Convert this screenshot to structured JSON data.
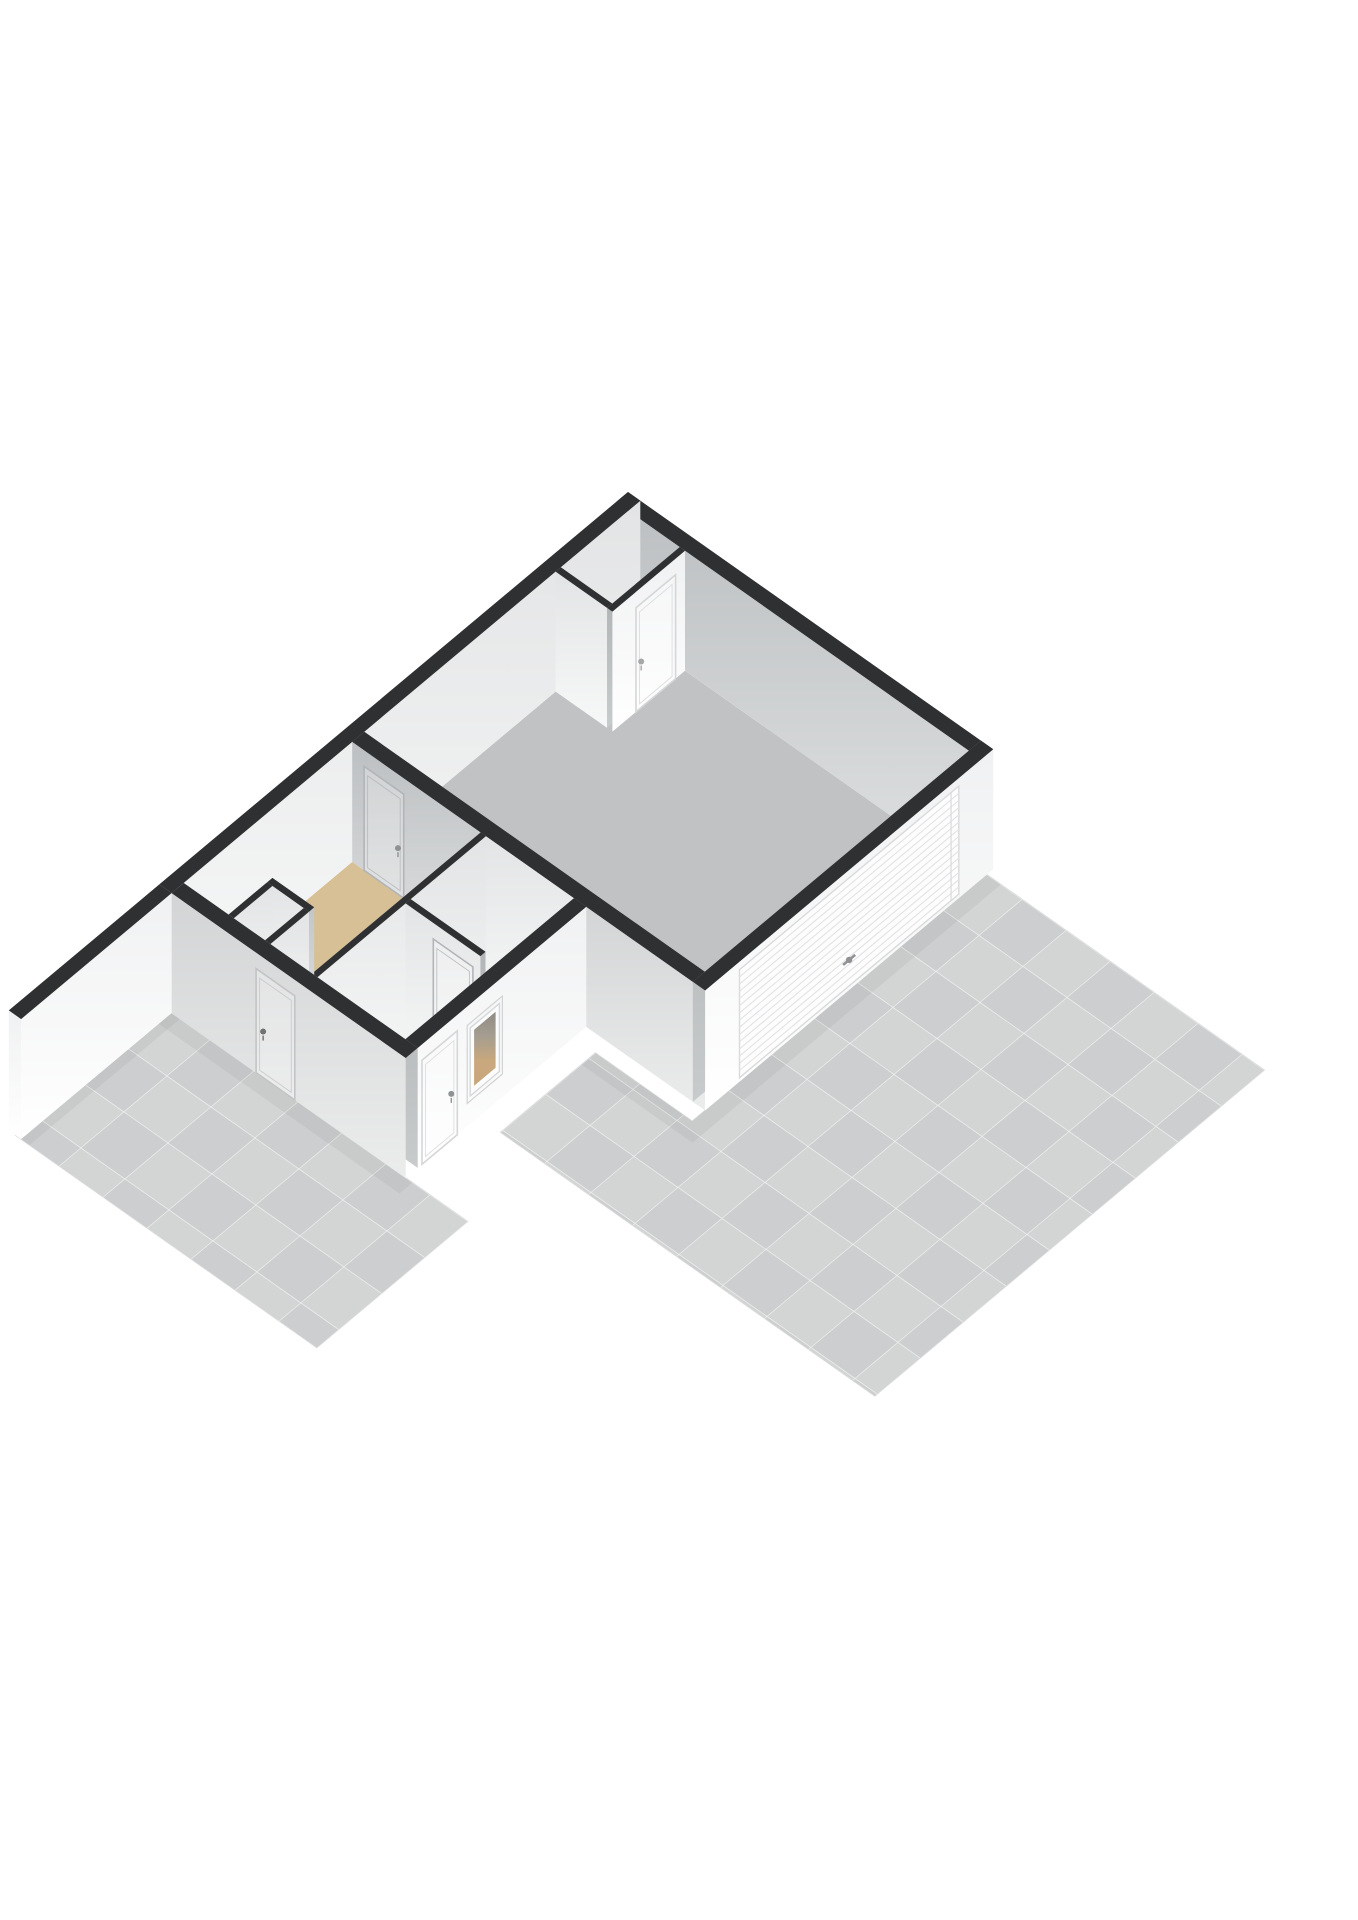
{
  "meta": {
    "type": "3d-floorplan-render",
    "background": "#ffffff",
    "canvas": [
      1358,
      1920
    ]
  },
  "projection": {
    "origin": [
      628,
      612
    ],
    "u": [
      44,
      31
    ],
    "v": [
      -43,
      36
    ],
    "wallHeight": 120
  },
  "palette": {
    "cap": "#2e3032",
    "floorGray": "#c0c2c3",
    "floorTan": "#d7bf96",
    "floorWhite": "#f1f2f2",
    "floorClosetGray": "#c7c9ca",
    "floorCloset2": "#ededee",
    "patioBase": "#d0d1d2",
    "tileEven": "#d3d4d4",
    "tileOdd": "#cdcecf",
    "tileLine": "rgba(255,255,255,0.45)",
    "patioEdge": "#dcdddd",
    "shade": "rgba(0,0,0,0.045)",
    "doorFrameWhite": "#d5d6d7",
    "doorFrameGray": "#b2b5b7",
    "doorFrameExt": "#c3c4c5",
    "handleDark": "#6f7173",
    "handleMid": "#8f9193",
    "handleLight": "#a5a7a9",
    "slatLine": "#e2e3e4",
    "slatBorder": "#d9dadb",
    "gradients": {
      "faceDark": [
        "#a9acae",
        "#c8cbcc"
      ],
      "faceMid": [
        "#bcbfc1",
        "#dfe1e2"
      ],
      "faceLight": [
        "#e3e4e5",
        "#f7f8f8"
      ],
      "faceWhite": [
        "#f0f1f2",
        "#ffffff"
      ],
      "faceExtGray": [
        "#d3d4d5",
        "#ebecec"
      ],
      "windowOpening": [
        "#8f8b85",
        "#a59d90",
        "#c9a87d",
        "#c8a77c"
      ]
    }
  },
  "patios": [
    {
      "name": "right-patio",
      "poly": [
        [
          8.3,
          0.15
        ],
        [
          14.6,
          0.15
        ],
        [
          14.6,
          9.2
        ],
        [
          6.1,
          9.2
        ],
        [
          6.1,
          7.0
        ],
        [
          8.3,
          7.0
        ]
      ],
      "tileOrigin": [
        6.1,
        0.15
      ],
      "tileCount": [
        9,
        10
      ],
      "shades": [
        [
          [
            8.3,
            0.15
          ],
          [
            8.62,
            0.15
          ],
          [
            8.62,
            7.0
          ],
          [
            8.3,
            7.0
          ]
        ],
        [
          [
            6.1,
            7.0
          ],
          [
            8.62,
            7.0
          ],
          [
            8.62,
            7.32
          ],
          [
            6.1,
            7.32
          ]
        ]
      ]
    },
    {
      "name": "left-patio",
      "poly": [
        [
          0.15,
          10.9
        ],
        [
          7.0,
          10.9
        ],
        [
          7.0,
          14.4
        ],
        [
          0.15,
          14.4
        ]
      ],
      "tileOrigin": [
        0.15,
        10.9
      ],
      "tileCount": [
        7,
        4
      ],
      "shades": [
        [
          [
            0.15,
            10.9
          ],
          [
            5.75,
            10.9
          ],
          [
            5.75,
            11.2
          ],
          [
            0.15,
            11.2
          ]
        ],
        [
          [
            0.15,
            10.9
          ],
          [
            0.47,
            10.9
          ],
          [
            0.47,
            14.4
          ],
          [
            0.15,
            14.4
          ]
        ]
      ]
    }
  ],
  "floors": [
    {
      "name": "garage-floor",
      "fill": "floorGray",
      "poly": [
        [
          0.28,
          0.28
        ],
        [
          8.02,
          0.28
        ],
        [
          8.02,
          6.42
        ],
        [
          0.28,
          6.42
        ]
      ]
    },
    {
      "name": "closet-floor",
      "fill": "floorClosetGray",
      "poly": [
        [
          0.28,
          0.28
        ],
        [
          1.45,
          0.28
        ],
        [
          1.45,
          1.85
        ],
        [
          0.28,
          1.85
        ]
      ]
    },
    {
      "name": "tan-room-floor",
      "fill": "floorTan",
      "poly": [
        [
          0.28,
          6.7
        ],
        [
          3.2,
          6.7
        ],
        [
          3.2,
          10.62
        ],
        [
          2.25,
          10.62
        ],
        [
          2.25,
          9.6
        ],
        [
          1.3,
          9.6
        ],
        [
          1.3,
          10.62
        ],
        [
          0.28,
          10.62
        ]
      ]
    },
    {
      "name": "toilet-floor",
      "fill": "floorWhite",
      "poly": [
        [
          3.32,
          6.7
        ],
        [
          5.02,
          6.7
        ],
        [
          5.02,
          8.45
        ],
        [
          3.32,
          8.45
        ]
      ]
    },
    {
      "name": "hall-floor",
      "fill": "floorWhite",
      "poly": [
        [
          3.32,
          8.57
        ],
        [
          5.02,
          8.57
        ],
        [
          5.02,
          10.62
        ],
        [
          3.32,
          10.62
        ]
      ]
    },
    {
      "name": "closet2-floor",
      "fill": "floorCloset2",
      "poly": [
        [
          1.42,
          9.72
        ],
        [
          2.13,
          9.72
        ],
        [
          2.13,
          10.62
        ],
        [
          1.42,
          10.62
        ]
      ]
    }
  ],
  "walls": [
    {
      "name": "wall-northeast",
      "rect": [
        0,
        8.3,
        0,
        0.28
      ],
      "faces": [
        {
          "side": "+y",
          "fill": "faceMid"
        }
      ]
    },
    {
      "name": "wall-northwest",
      "rect": [
        0,
        0.28,
        0,
        10.9
      ],
      "faces": [
        {
          "side": "+x",
          "fill": "faceLight"
        }
      ]
    },
    {
      "name": "closet-wall-south",
      "rect": [
        0.28,
        1.45,
        1.85,
        1.97
      ],
      "faces": [
        {
          "side": "-y",
          "fill": "faceDark"
        },
        {
          "side": "+y",
          "fill": "faceLight"
        }
      ]
    },
    {
      "name": "closet-wall-east",
      "rect": [
        1.45,
        1.57,
        0.28,
        1.97
      ],
      "faces": [
        {
          "side": "-x",
          "fill": "faceDark"
        },
        {
          "side": "+x",
          "fill": "faceWhite",
          "features": [
            {
              "type": "door",
              "t0": 0.5,
              "t1": 1.42,
              "z1": 104,
              "frame": "doorFrameWhite",
              "handle": {
                "t": 1.3,
                "z": 46,
                "color": "handleLight"
              }
            }
          ]
        }
      ]
    },
    {
      "name": "wall-garage-south",
      "rect": [
        0.28,
        8.3,
        6.42,
        6.7
      ],
      "faces": [
        {
          "side": "-y",
          "fill": "faceDark"
        },
        {
          "side": "+y",
          "t0": 0.28,
          "t1": 3.26,
          "fill": "faceMid",
          "features": [
            {
              "type": "door",
              "t0": 0.55,
              "t1": 1.45,
              "z1": 104,
              "frame": "doorFrameGray",
              "handle": {
                "t": 1.32,
                "z": 46,
                "color": "handleMid"
              }
            }
          ]
        },
        {
          "side": "+y",
          "t0": 3.26,
          "t1": 5.45,
          "fill": "faceLight"
        },
        {
          "side": "+y",
          "t0": 5.45,
          "t1": 8.3,
          "fill": "faceExtGray"
        }
      ]
    },
    {
      "name": "wall-partition-tan",
      "rect": [
        3.2,
        3.32,
        6.7,
        10.62
      ],
      "faces": [
        {
          "side": "-x",
          "fill": "faceMid",
          "features": [
            {
              "type": "door",
              "t0": 6.85,
              "t1": 7.75,
              "z1": 104,
              "frame": "doorFrameGray",
              "handle": {
                "t": 7.6,
                "z": 46,
                "color": "handleMid"
              }
            }
          ]
        },
        {
          "side": "+x",
          "fill": "faceLight"
        }
      ]
    },
    {
      "name": "wall-partition-hall",
      "rect": [
        3.32,
        5.02,
        8.45,
        8.57
      ],
      "faces": [
        {
          "side": "-y",
          "fill": "faceDark"
        },
        {
          "side": "+y",
          "fill": "faceLight",
          "features": [
            {
              "type": "door",
              "t0": 3.95,
              "t1": 4.85,
              "z1": 104,
              "frame": "doorFrameGray",
              "handle": {
                "t": 4.7,
                "z": 46,
                "color": "handleMid"
              }
            }
          ]
        }
      ]
    },
    {
      "name": "wall-garage-east",
      "rect": [
        8.02,
        8.3,
        0,
        6.7
      ],
      "faces": [
        {
          "side": "-x",
          "fill": "faceDark"
        },
        {
          "side": "+x",
          "fill": "faceWhite",
          "features": [
            {
              "type": "slats",
              "t0": 0.8,
              "t1": 5.9,
              "z0": 4,
              "z1": 112,
              "count": 15
            },
            {
              "type": "handle",
              "t": 3.35,
              "z": 30,
              "color": "handleMid"
            }
          ]
        }
      ]
    },
    {
      "name": "closet2-wall-north",
      "rect": [
        1.3,
        2.25,
        9.6,
        9.72
      ],
      "faces": [
        {
          "side": "-y",
          "fill": "faceMid"
        },
        {
          "side": "+y",
          "fill": "faceLight"
        }
      ]
    },
    {
      "name": "closet2-wall-west",
      "rect": [
        1.3,
        1.42,
        9.72,
        10.62
      ],
      "faces": [
        {
          "side": "-x",
          "fill": "faceMid"
        },
        {
          "side": "+x",
          "fill": "faceLight"
        }
      ]
    },
    {
      "name": "closet2-wall-east",
      "rect": [
        2.13,
        2.25,
        9.72,
        10.62
      ],
      "faces": [
        {
          "side": "-x",
          "fill": "faceDark"
        },
        {
          "side": "+x",
          "fill": "faceLight"
        }
      ]
    },
    {
      "name": "wall-southeast-wing",
      "rect": [
        5.32,
        5.6,
        6.7,
        10.9
      ],
      "faces": [
        {
          "side": "-x",
          "fill": "faceDark",
          "features": [
            {
              "type": "doorOutline",
              "t0": 9.7,
              "t1": 10.52,
              "z1": 104
            }
          ]
        },
        {
          "side": "+x",
          "fill": "faceWhite",
          "features": [
            {
              "type": "window",
              "t0": 8.72,
              "t1": 9.4,
              "z0": 28,
              "z1": 96
            },
            {
              "type": "door",
              "t0": 9.7,
              "t1": 10.52,
              "z1": 104,
              "frame": "doorFrameWhite",
              "handle": {
                "t": 9.84,
                "z": 46,
                "color": "handleMid"
              }
            }
          ]
        }
      ]
    },
    {
      "name": "wall-southwest",
      "rect": [
        0.28,
        5.6,
        10.62,
        10.9
      ],
      "faces": [
        {
          "side": "-y",
          "fill": "faceDark",
          "features": [
            {
              "type": "doorOutline",
              "t0": 2.2,
              "t1": 3.08,
              "z1": 104
            }
          ]
        },
        {
          "side": "+y",
          "fill": "faceExtGray",
          "features": [
            {
              "type": "door",
              "t0": 2.2,
              "t1": 3.08,
              "z1": 104,
              "frame": "doorFrameExt",
              "handle": {
                "t": 2.36,
                "z": 46,
                "color": "handleDark"
              }
            }
          ]
        }
      ]
    },
    {
      "name": "garden-wall",
      "rect": [
        0,
        0.28,
        10.9,
        14.4
      ],
      "faces": [
        {
          "side": "+x",
          "fill": "faceWhite"
        },
        {
          "side": "endY",
          "fill": "faceWhite"
        }
      ]
    }
  ]
}
